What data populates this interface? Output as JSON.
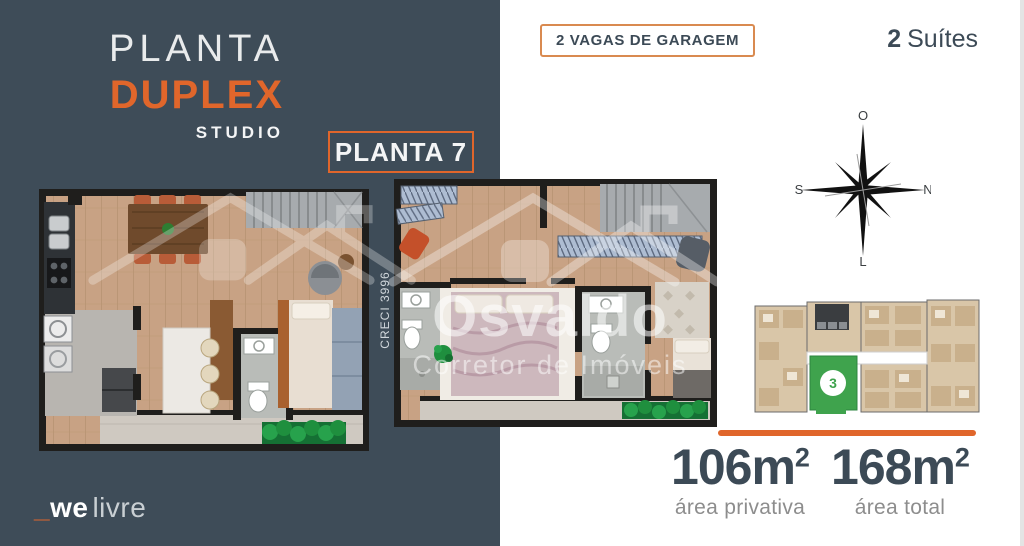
{
  "colors": {
    "panel": "#3E4C58",
    "accent": "#E0662B",
    "text_dark": "#3C4A56",
    "text_gray": "#8D8D8D",
    "unit_green": "#3FA34D"
  },
  "panel": {
    "title_line1": "PLANTA",
    "title_line2": "DUPLEX",
    "title_line3": "STUDIO",
    "badge": "PLANTA 7",
    "brand": {
      "prefix": "_",
      "bold": "we",
      "light": "livre"
    }
  },
  "right": {
    "garage_badge": "2 VAGAS DE GARAGEM",
    "suites_number": "2",
    "suites_label": "Suítes",
    "compass": {
      "top": "O",
      "right": "N",
      "bottom": "L",
      "left": "S"
    },
    "site_unit": "3",
    "areas": [
      {
        "value": "106m",
        "sup": "2",
        "label": "área privativa"
      },
      {
        "value": "168m",
        "sup": "2",
        "label": "área total"
      }
    ]
  },
  "watermark": {
    "name": "Osvaldo",
    "subtitle": "Corretor de Imóveis",
    "creci": "CRECI 3996"
  }
}
